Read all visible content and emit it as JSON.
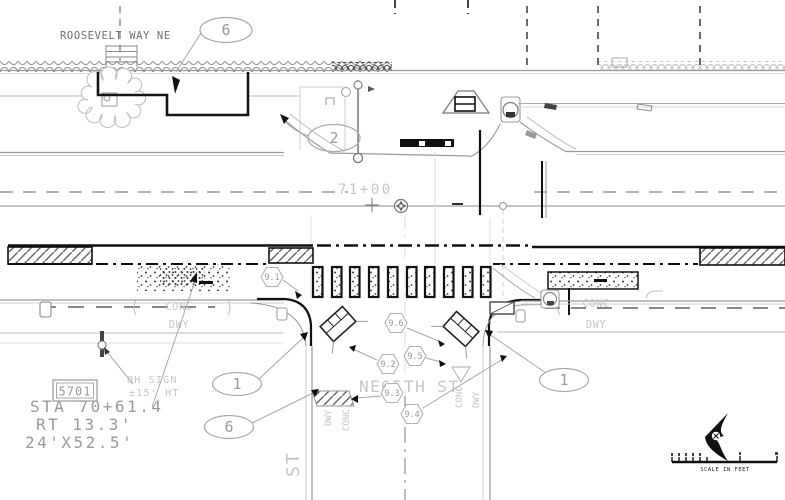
{
  "colors": {
    "paper": "#ffffff",
    "ink": "#1a1a1a",
    "gray": "#999999",
    "light_gray": "#c8c8c8"
  },
  "plan": {
    "street_top": "ROOSEVELT WAY NE",
    "station": "71+00",
    "cross_street_prefix": "NE",
    "cross_street_number": "65",
    "cross_street_suffix": "TH ST",
    "rotated_street": "ST",
    "pavement_labels": {
      "left_conc": "CONC",
      "left_dwy": "DWY",
      "right_conc": "CONC",
      "right_dwy": "DWY",
      "ramp_left_dwy": "DWY",
      "ramp_left_conc": "CONC",
      "ramp_right_conc": "CONC",
      "ramp_right_dwy": "DWY"
    },
    "sign": {
      "id": "5701",
      "sta": "STA 70+61.4",
      "offset": "RT 13.3'",
      "size": "24'X52.5'"
    },
    "oh_sign_line1": "OH SIGN",
    "oh_sign_line2": "±15' HT",
    "callouts": {
      "top": "6",
      "driveway": "2",
      "left_ramp": "1",
      "left_wall": "6",
      "right_ramp": "1"
    },
    "keynotes": {
      "k1": "9.1",
      "k2": "9.2",
      "k3": "9.3",
      "k4": "9.4",
      "k5": "9.5",
      "k6": "9.6"
    },
    "scale_label": "SCALE IN FEET"
  }
}
